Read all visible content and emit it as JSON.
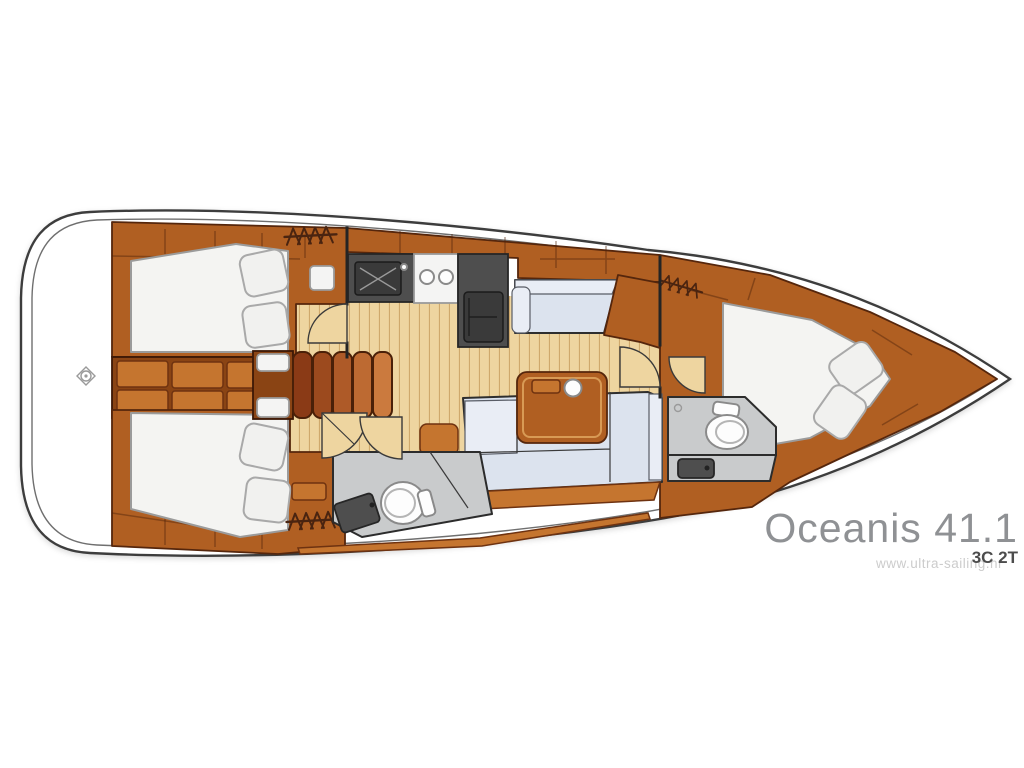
{
  "branding": {
    "model": "Oceanis 41.1",
    "layout_code": "3C 2T",
    "watermark": "www.ultra-sailing.hr"
  },
  "icons": {
    "hanging_locker": "zigzag-rail-icon",
    "stern_fitting": "diamond-ring-icon"
  },
  "colors": {
    "wood": "#b05f22",
    "woodDark": "#8a4414",
    "woodLight": "#c5752f",
    "floor": "#eed5a0",
    "floorLine": "#cfa96c",
    "mattress": "#f4f4f2",
    "sofa": "#dce3ee",
    "sofaLight": "#e9edf5",
    "counter": "#4e4e4e",
    "counterInner": "#3a3a3a",
    "headFloor": "#c9cbcc",
    "hullStroke": "#3e3e3e",
    "textGray": "#8f9194",
    "textDark": "#4c4c4c",
    "watermarkGray": "#cccccc",
    "symbol": "#4a2410"
  }
}
